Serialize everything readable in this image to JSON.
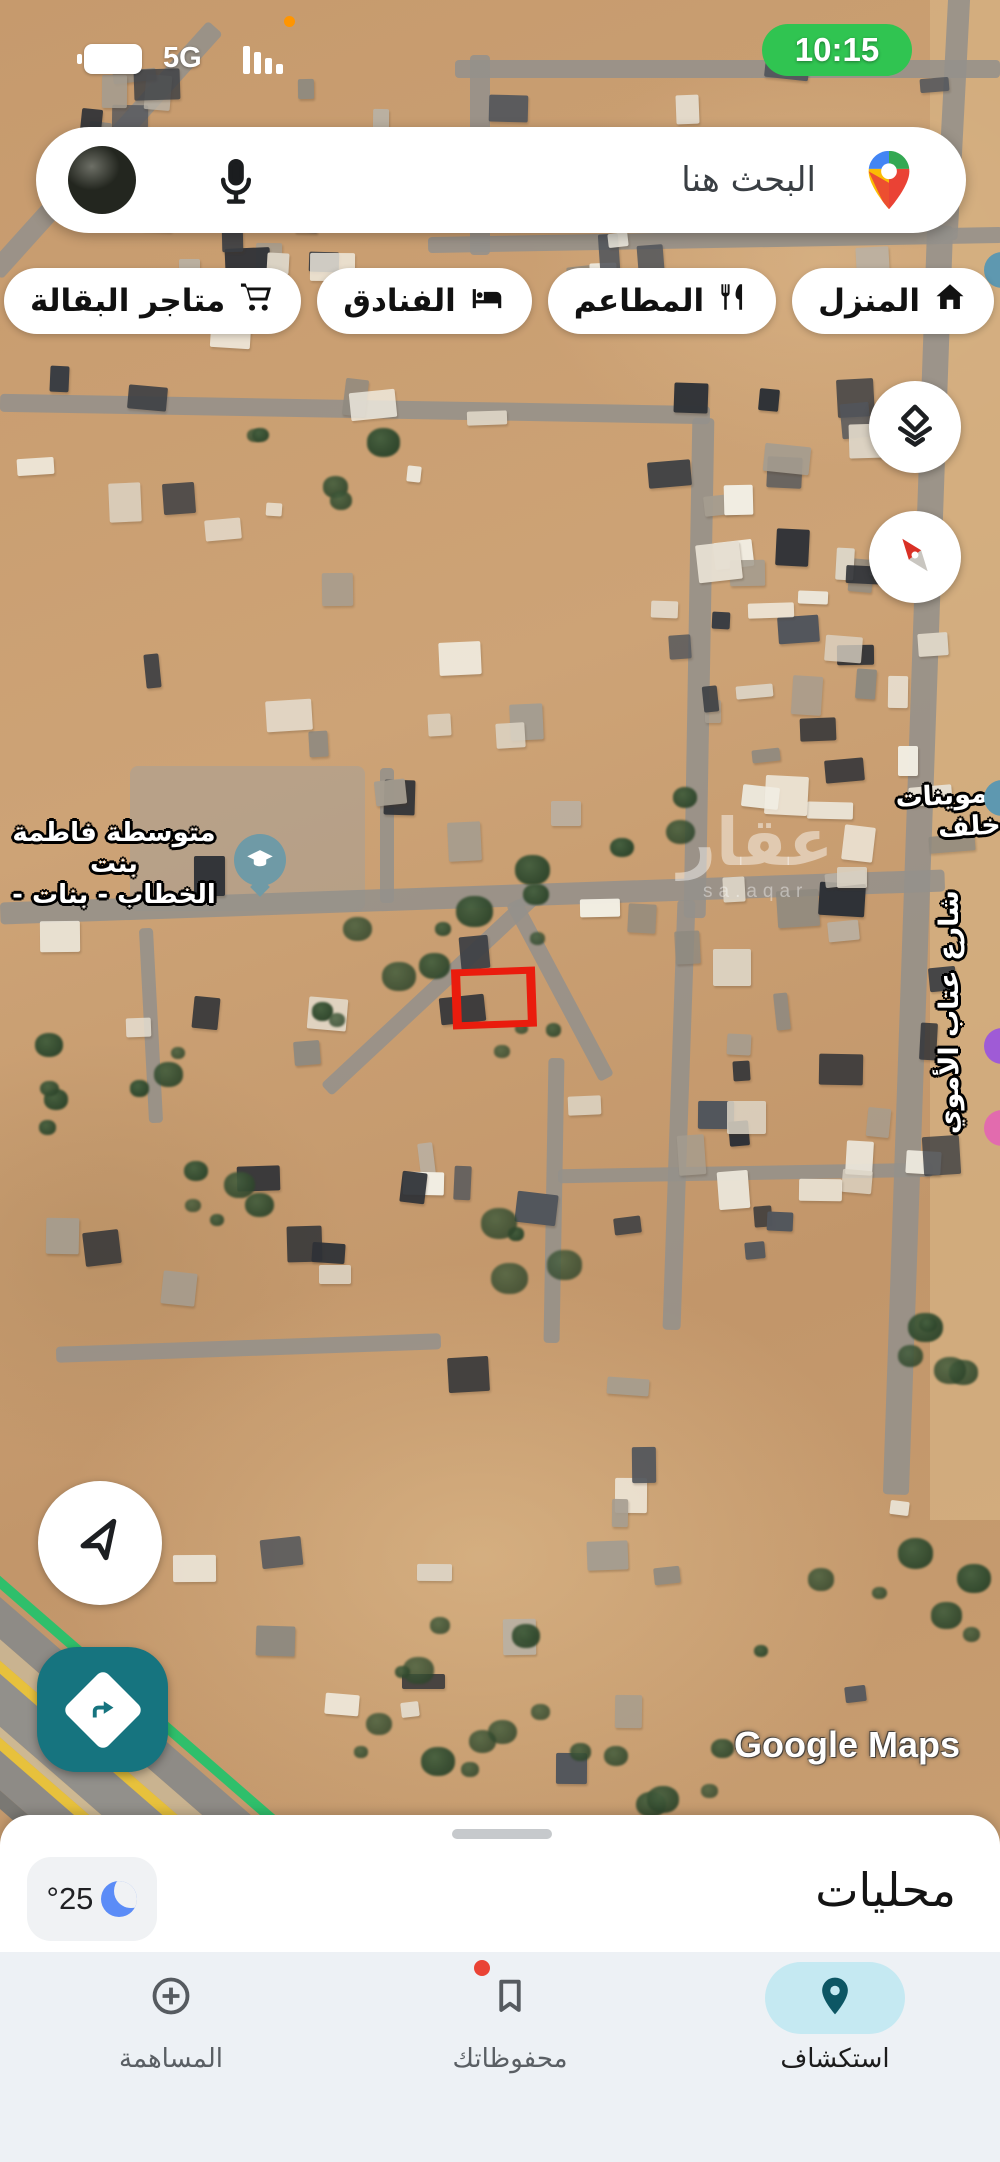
{
  "status_bar": {
    "time": "10:15",
    "network": "5G",
    "battery_icon": "battery-icon",
    "signal_icon": "signal-strength-icon",
    "recording_dot_icon": "mic-in-use-dot"
  },
  "search_bar": {
    "placeholder": "البحث هنا",
    "avatar_icon": "user-avatar",
    "mic_icon": "microphone-icon",
    "logo_icon": "google-maps-pin-icon"
  },
  "chips": [
    {
      "label": "المنزل",
      "icon": "home-icon"
    },
    {
      "label": "المطاعم",
      "icon": "restaurants-icon"
    },
    {
      "label": "الفنادق",
      "icon": "hotels-bed-icon"
    },
    {
      "label": "متاجر البقالة",
      "icon": "grocery-cart-icon"
    },
    {
      "label": "وقود",
      "icon": "fuel-pump-icon"
    }
  ],
  "map": {
    "controls": {
      "layers_icon": "layers-icon",
      "compass_icon": "compass-icon",
      "my_location_icon": "my-location-arrow-icon",
      "directions_icon": "directions-icon"
    },
    "poi": {
      "school_label_line1": "متوسطة فاطمة بنت",
      "school_label_line2": "الخطاب - بنات -",
      "school_icon": "school-graduation-cap-icon",
      "store_label": "تموينات خلف",
      "street_label": "شارع عتاب الأموي"
    },
    "watermark": {
      "text": "عقار",
      "subtext": "sa.aqar"
    },
    "attribution": "Google Maps"
  },
  "bottom_sheet": {
    "title": "محليات",
    "weather": {
      "temperature": "°25",
      "moon_icon": "crescent-moon-icon"
    }
  },
  "bottom_nav": {
    "items": [
      {
        "label": "استكشاف",
        "icon": "explore-pin-icon",
        "selected": true
      },
      {
        "label": "محفوظاتك",
        "icon": "saved-bookmark-icon",
        "selected": false,
        "badge": true
      },
      {
        "label": "المساهمة",
        "icon": "contribute-plus-icon",
        "selected": false
      }
    ]
  },
  "colors": {
    "time_pill_green": "#30c451",
    "highlight_red": "#ea1c0d",
    "directions_teal": "#16747f",
    "selected_nav_pill": "#c5e9f2"
  }
}
